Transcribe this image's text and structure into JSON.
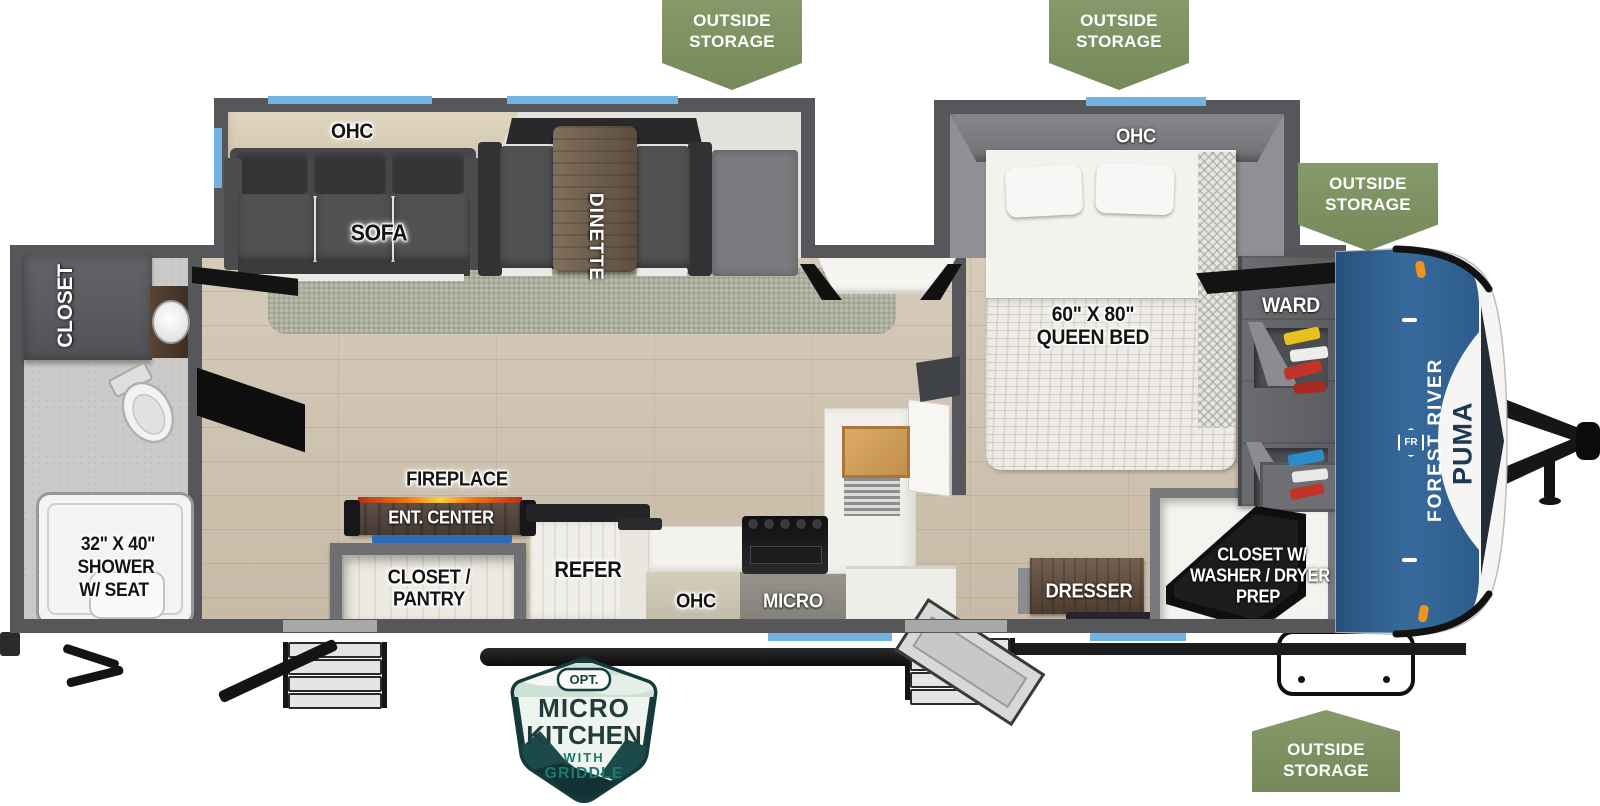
{
  "banner": {
    "line1": "OUTSIDE",
    "line2": "STORAGE"
  },
  "brand": {
    "maker": "FOREST RIVER",
    "model": "PUMA",
    "monogram": "FR"
  },
  "badge": {
    "tag": "OPT.",
    "line1": "MICRO",
    "line2": "KITCHEN",
    "line3": "WITH",
    "line4": "GRIDDLE"
  },
  "labels": {
    "ohc": "OHC",
    "sofa": "SOFA",
    "dinette": "DINETTE",
    "bed_size": "60\" X 80\"",
    "bed_name": "QUEEN BED",
    "ward": "WARD",
    "rear_closet": "CLOSET",
    "shower_size": "32\" X 40\"",
    "shower_name": "SHOWER",
    "shower_suffix": "W/ SEAT",
    "fireplace": "FIREPLACE",
    "ent_center": "ENT. CENTER",
    "pantry_line1": "CLOSET /",
    "pantry_line2": "PANTRY",
    "refer": "REFER",
    "micro": "MICRO",
    "dresser": "DRESSER",
    "wd_line1": "CLOSET W/",
    "wd_line2": "WASHER / DRYER",
    "wd_line3": "PREP"
  },
  "colors": {
    "banner_green": "#7c9161",
    "window_blue": "#74b2e2",
    "wall_gray": "#56575b",
    "cap_blue": "#31608e",
    "badge_teal": "#16393c",
    "flame_orange": "#f07818"
  }
}
